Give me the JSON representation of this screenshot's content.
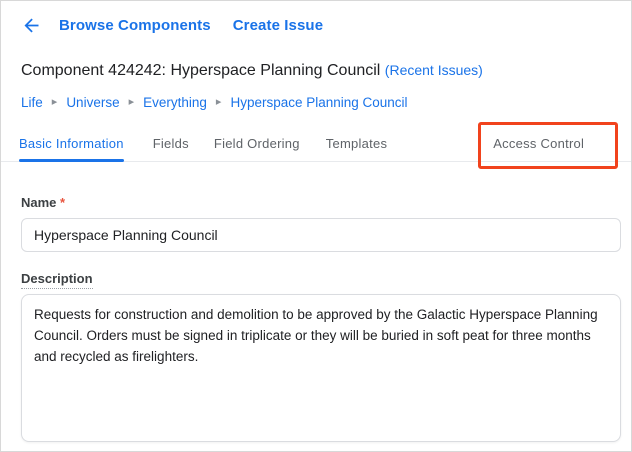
{
  "colors": {
    "link_blue": "#1a73e8",
    "text_dark": "#202124",
    "tab_inactive_gray": "#5f6368",
    "annotation_red": "#f1431d",
    "required_red": "#e8543e"
  },
  "topbar": {
    "browse_components_label": "Browse Components",
    "create_issue_label": "Create Issue"
  },
  "header": {
    "title": "Component 424242: Hyperspace Planning Council",
    "recent_issues_link": "(Recent Issues)"
  },
  "breadcrumb": {
    "separator": "▸",
    "items": [
      "Life",
      "Universe",
      "Everything",
      "Hyperspace Planning Council"
    ]
  },
  "tabs": {
    "items": [
      {
        "label": "Basic Information",
        "active": true
      },
      {
        "label": "Fields",
        "active": false
      },
      {
        "label": "Field Ordering",
        "active": false
      },
      {
        "label": "Templates",
        "active": false
      },
      {
        "label": "Access Control",
        "active": false,
        "highlighted": true
      }
    ]
  },
  "form": {
    "name": {
      "label": "Name",
      "required_marker": "*",
      "value": "Hyperspace Planning Council"
    },
    "description": {
      "label": "Description",
      "value": "Requests for construction and demolition to be approved by the Galactic Hyperspace Planning Council. Orders must be signed in triplicate or they will be buried in soft peat for three months and recycled as firelighters."
    }
  }
}
